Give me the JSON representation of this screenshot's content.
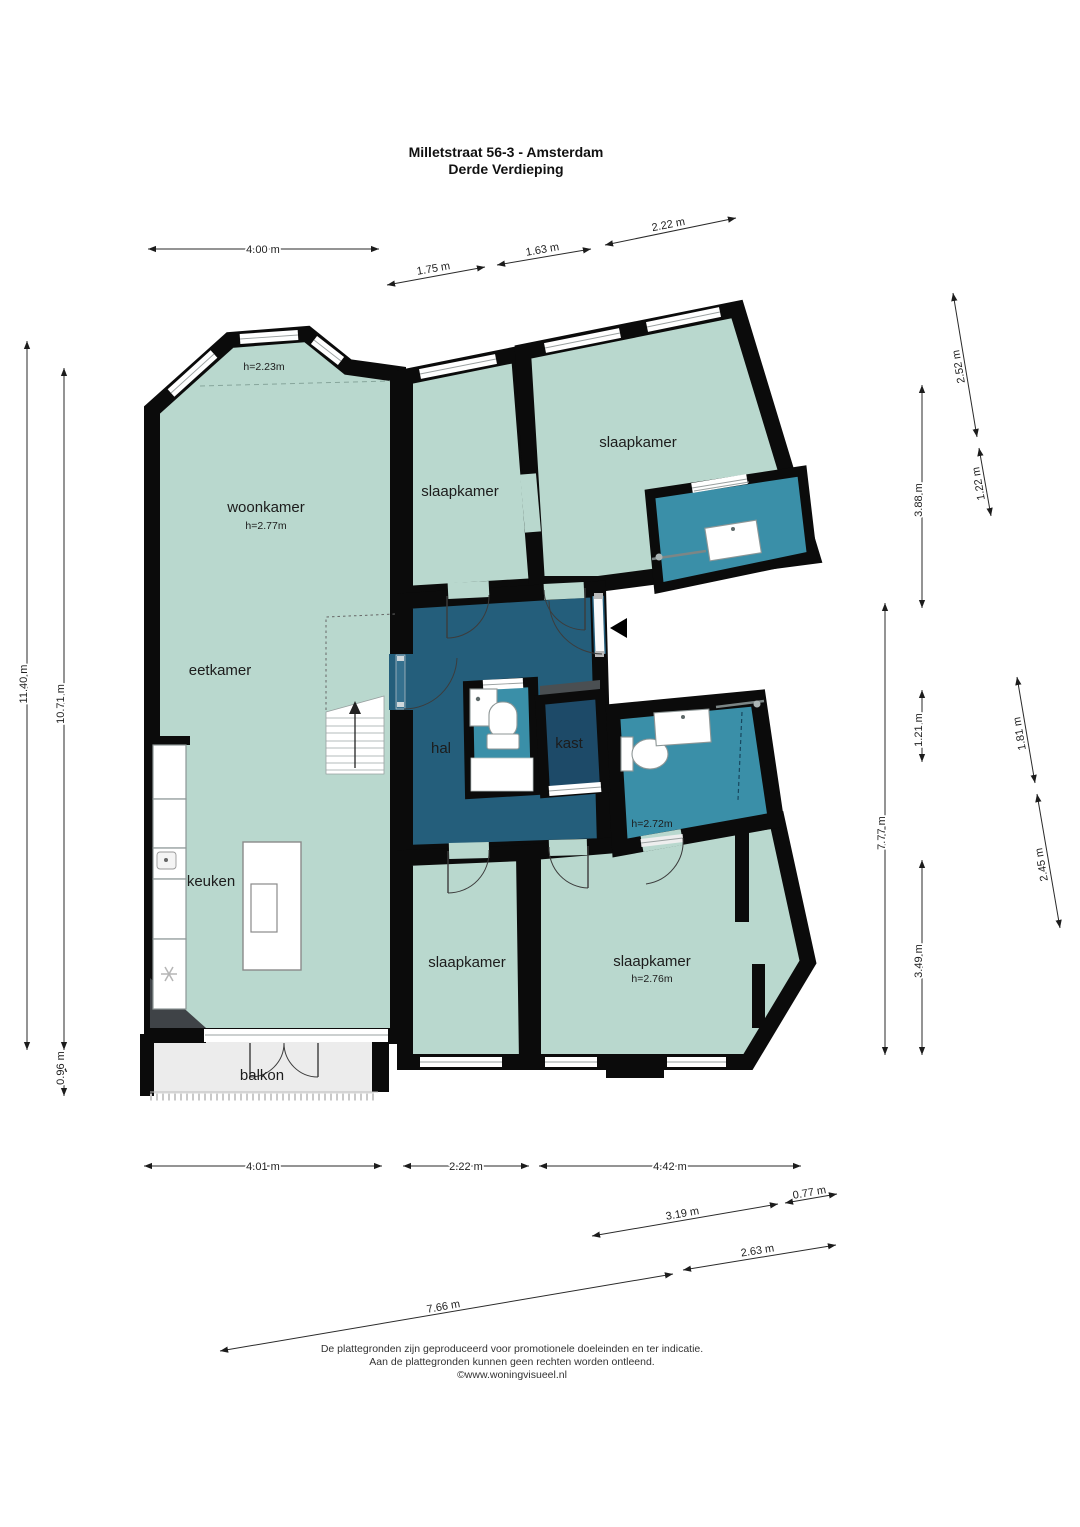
{
  "title": {
    "line1": "Milletstraat 56-3 - Amsterdam",
    "line2": "Derde Verdieping"
  },
  "rooms": {
    "woonkamer": {
      "name": "woonkamer",
      "ceiling": "h=2.77m"
    },
    "erker": {
      "ceiling": "h=2.23m"
    },
    "eetkamer": {
      "name": "eetkamer"
    },
    "keuken": {
      "name": "keuken"
    },
    "balkon": {
      "name": "balkon"
    },
    "hal": {
      "name": "hal"
    },
    "kast": {
      "name": "kast"
    },
    "badkamer": {
      "ceiling": "h=2.72m"
    },
    "slaapkamer_top_left": {
      "name": "slaapkamer"
    },
    "slaapkamer_top_right": {
      "name": "slaapkamer"
    },
    "slaapkamer_bottom_left": {
      "name": "slaapkamer"
    },
    "slaapkamer_bottom_right": {
      "name": "slaapkamer",
      "ceiling": "h=2.76m"
    }
  },
  "dimensions": {
    "top": [
      {
        "label": "4.00 m"
      },
      {
        "label": "1.75 m"
      },
      {
        "label": "1.63 m"
      },
      {
        "label": "2.22 m"
      }
    ],
    "left": [
      {
        "label": "11.40 m"
      },
      {
        "label": "10.71 m"
      },
      {
        "label": "0.96 m"
      }
    ],
    "right": [
      {
        "label": "2.52 m"
      },
      {
        "label": "1.22 m"
      },
      {
        "label": "3.88 m"
      },
      {
        "label": "1.21 m"
      },
      {
        "label": "7.77 m"
      },
      {
        "label": "1.81 m"
      },
      {
        "label": "2.45 m"
      },
      {
        "label": "3.49 m"
      }
    ],
    "bottom": [
      {
        "label": "4.01 m"
      },
      {
        "label": "2.22 m"
      },
      {
        "label": "4.42 m"
      },
      {
        "label": "3.19 m"
      },
      {
        "label": "0.77 m"
      },
      {
        "label": "2.63 m"
      },
      {
        "label": "7.66 m"
      }
    ]
  },
  "footer": {
    "line1": "De plattegronden zijn geproduceerd voor promotionele doeleinden en ter indicatie.",
    "line2": "Aan de plattegronden kunnen geen rechten worden ontleend.",
    "line3": "©www.woningvisueel.nl"
  },
  "colors": {
    "room": "#b9d8ce",
    "hall": "#245e7b",
    "bathroom": "#3a8fa8",
    "closet": "#1d4a68",
    "balcony": "#ececec",
    "wall": "#0b0b0b"
  }
}
